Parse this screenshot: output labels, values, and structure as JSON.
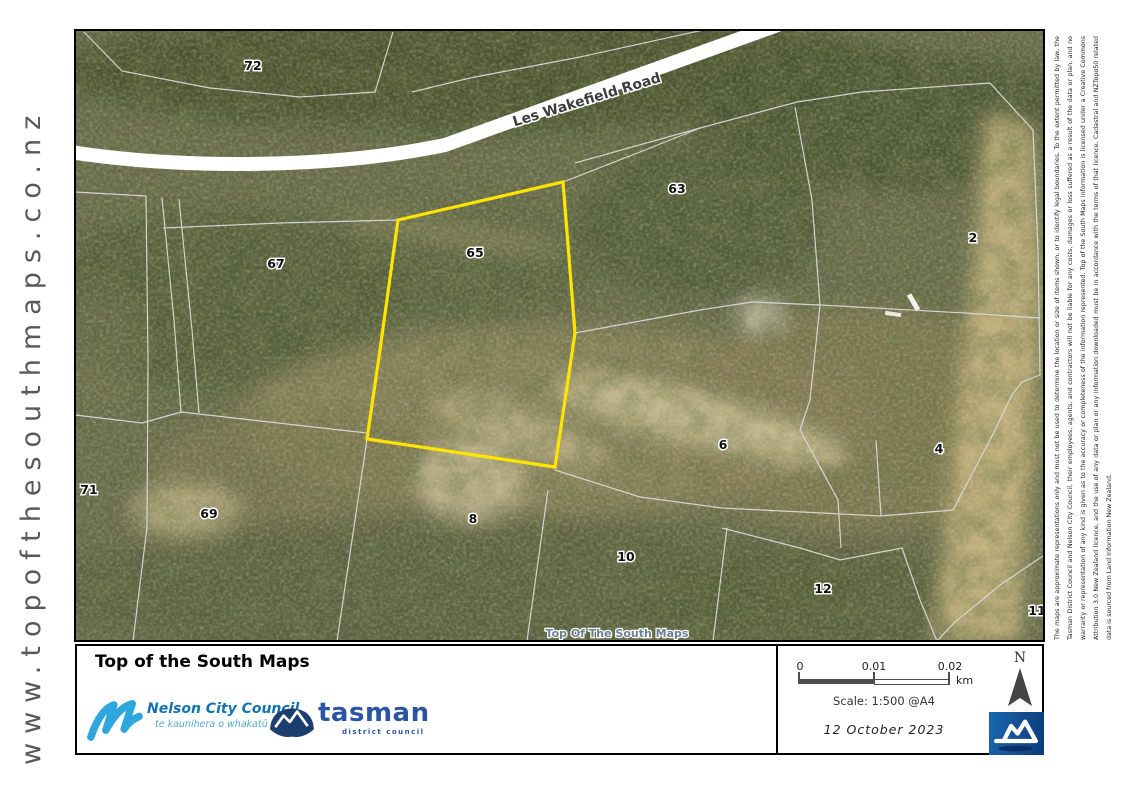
{
  "site_watermark": "www.topofthesouthmaps.co.nz",
  "map": {
    "road_label": "Les Wakefield Road",
    "center_watermark": "Top Of The South Maps",
    "highlight_color": "#FFE400",
    "highlighted_parcel": "65",
    "parcel_labels": [
      "72",
      "63",
      "65",
      "67",
      "2",
      "71",
      "69",
      "8",
      "6",
      "10",
      "12",
      "4",
      "11"
    ]
  },
  "footer": {
    "title": "Top of the South Maps",
    "nelson_logo": {
      "name": "Nelson City Council",
      "tagline": "te kaunihera o whakatū"
    },
    "tasman_logo": {
      "name": "tasman",
      "tagline": "district council"
    },
    "scale_bar": {
      "tick_0": "0",
      "tick_1": "0.01",
      "tick_2": "0.02",
      "unit": "km"
    },
    "scale_text": "Scale: 1:500 @A4",
    "date": "12 October 2023",
    "north_label": "N"
  },
  "disclaimer": "The maps are approximate representations only and must not be used to determine the location or size of items shown, or to identify legal boundaries. To the extent permitted by law, the Tasman District Council and Nelson City Council, their employees, agents, and contractors will not be liable for any costs, damages or loss suffered as a result of the data or plan, and no warranty or representation of any kind is given as to the accuracy or completeness of the information represented. Top of the South Maps information is licensed under a Creative Commons Attribution 3.0 New Zealand licence, and the use of any data or plan or any information downloaded must be in accordance with the terms of that licence. Cadastral and NZTopo50 related data is sourced from Land Information New Zealand."
}
